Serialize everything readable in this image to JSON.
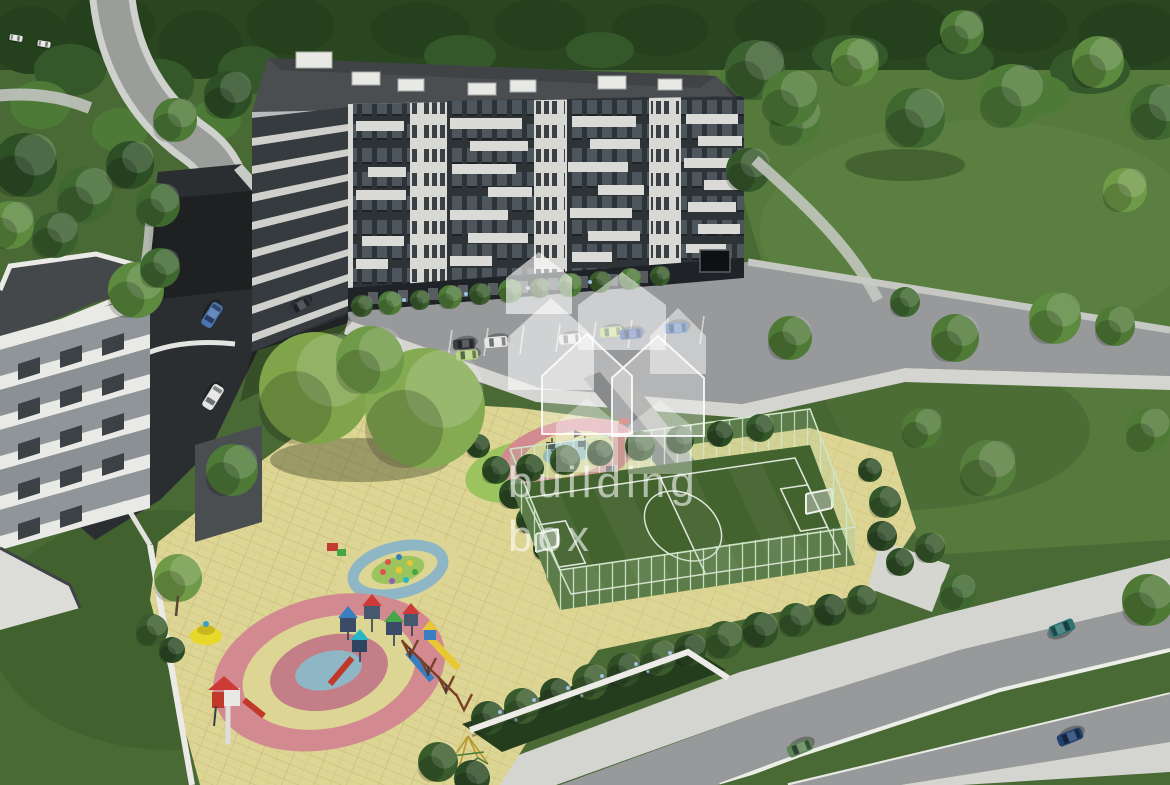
{
  "meta": {
    "type": "architectural-aerial-render",
    "subject": "Aerial 3D visualization of a residential complex with an 8-storey apartment building, terraced white building, parking, children's playground, fenced mini football pitch, park and roads"
  },
  "watermark": {
    "line1": "building",
    "line2": "box",
    "logo": "house-cluster-icon"
  },
  "palette": {
    "grass": "#4a6a35",
    "lawn_light": "#567a3c",
    "forest_dark": "#27421f",
    "forest_mid": "#3a5f2e",
    "tree_light": "#6f9a47",
    "asphalt": "#2b2e30",
    "road_gray": "#97999b",
    "sidewalk": "#d4d5d1",
    "paving_light": "#c8cac6",
    "paving_yellow": "#ddd593",
    "ring_pink": "#d28a90",
    "ring_pink_dark": "#c47e88",
    "ring_blue": "#8fb6c4",
    "ring_green": "#9cc45e",
    "pitch_green": "#42632e",
    "pitch_line": "#e9ede5",
    "fence_green": "#bcd9b2",
    "facade_dark": "#2e3338",
    "facade_light": "#d8d8d4",
    "roof_gray": "#4a4e51",
    "ground_floor": "#1f2327",
    "white_building": "#e9e9e6",
    "wall_white": "#eceae6",
    "hedge_green": "#2c4a24",
    "flower_blue": "#9fc0e0",
    "watermark_white": "rgba(255,255,255,0.58)"
  },
  "cars": [
    {
      "label": "blue-car-street",
      "color": "#4a74b0"
    },
    {
      "label": "white-car-street",
      "color": "#e4e5e3"
    },
    {
      "label": "dark-car-corner",
      "color": "#34383c"
    },
    {
      "label": "dark-car-parked",
      "color": "#3c4044"
    },
    {
      "label": "green-car-parked",
      "color": "#b9d385"
    },
    {
      "label": "white-van-parked",
      "color": "#e6e7e5"
    },
    {
      "label": "white-car-parked",
      "color": "#dfe0de"
    },
    {
      "label": "light-green-car-parked",
      "color": "#b6d07f"
    },
    {
      "label": "navy-car-parked",
      "color": "#35539c"
    },
    {
      "label": "blue-car-parked",
      "color": "#3f6fb5"
    },
    {
      "label": "teal-car-road",
      "color": "#2f7472"
    },
    {
      "label": "navy-car-road",
      "color": "#22406e"
    },
    {
      "label": "green-car-road",
      "color": "#5d8456"
    },
    {
      "label": "tiny-car-a",
      "color": "#e7e8e6"
    },
    {
      "label": "tiny-car-b",
      "color": "#e7e8e6"
    }
  ],
  "scene_areas": [
    "forest and park",
    "main apartment building",
    "terraced white building",
    "parking lot with cars",
    "children playground with colored circles",
    "mini football pitch with green fence",
    "roads and sidewalks",
    "hedge planter with retaining wall"
  ]
}
